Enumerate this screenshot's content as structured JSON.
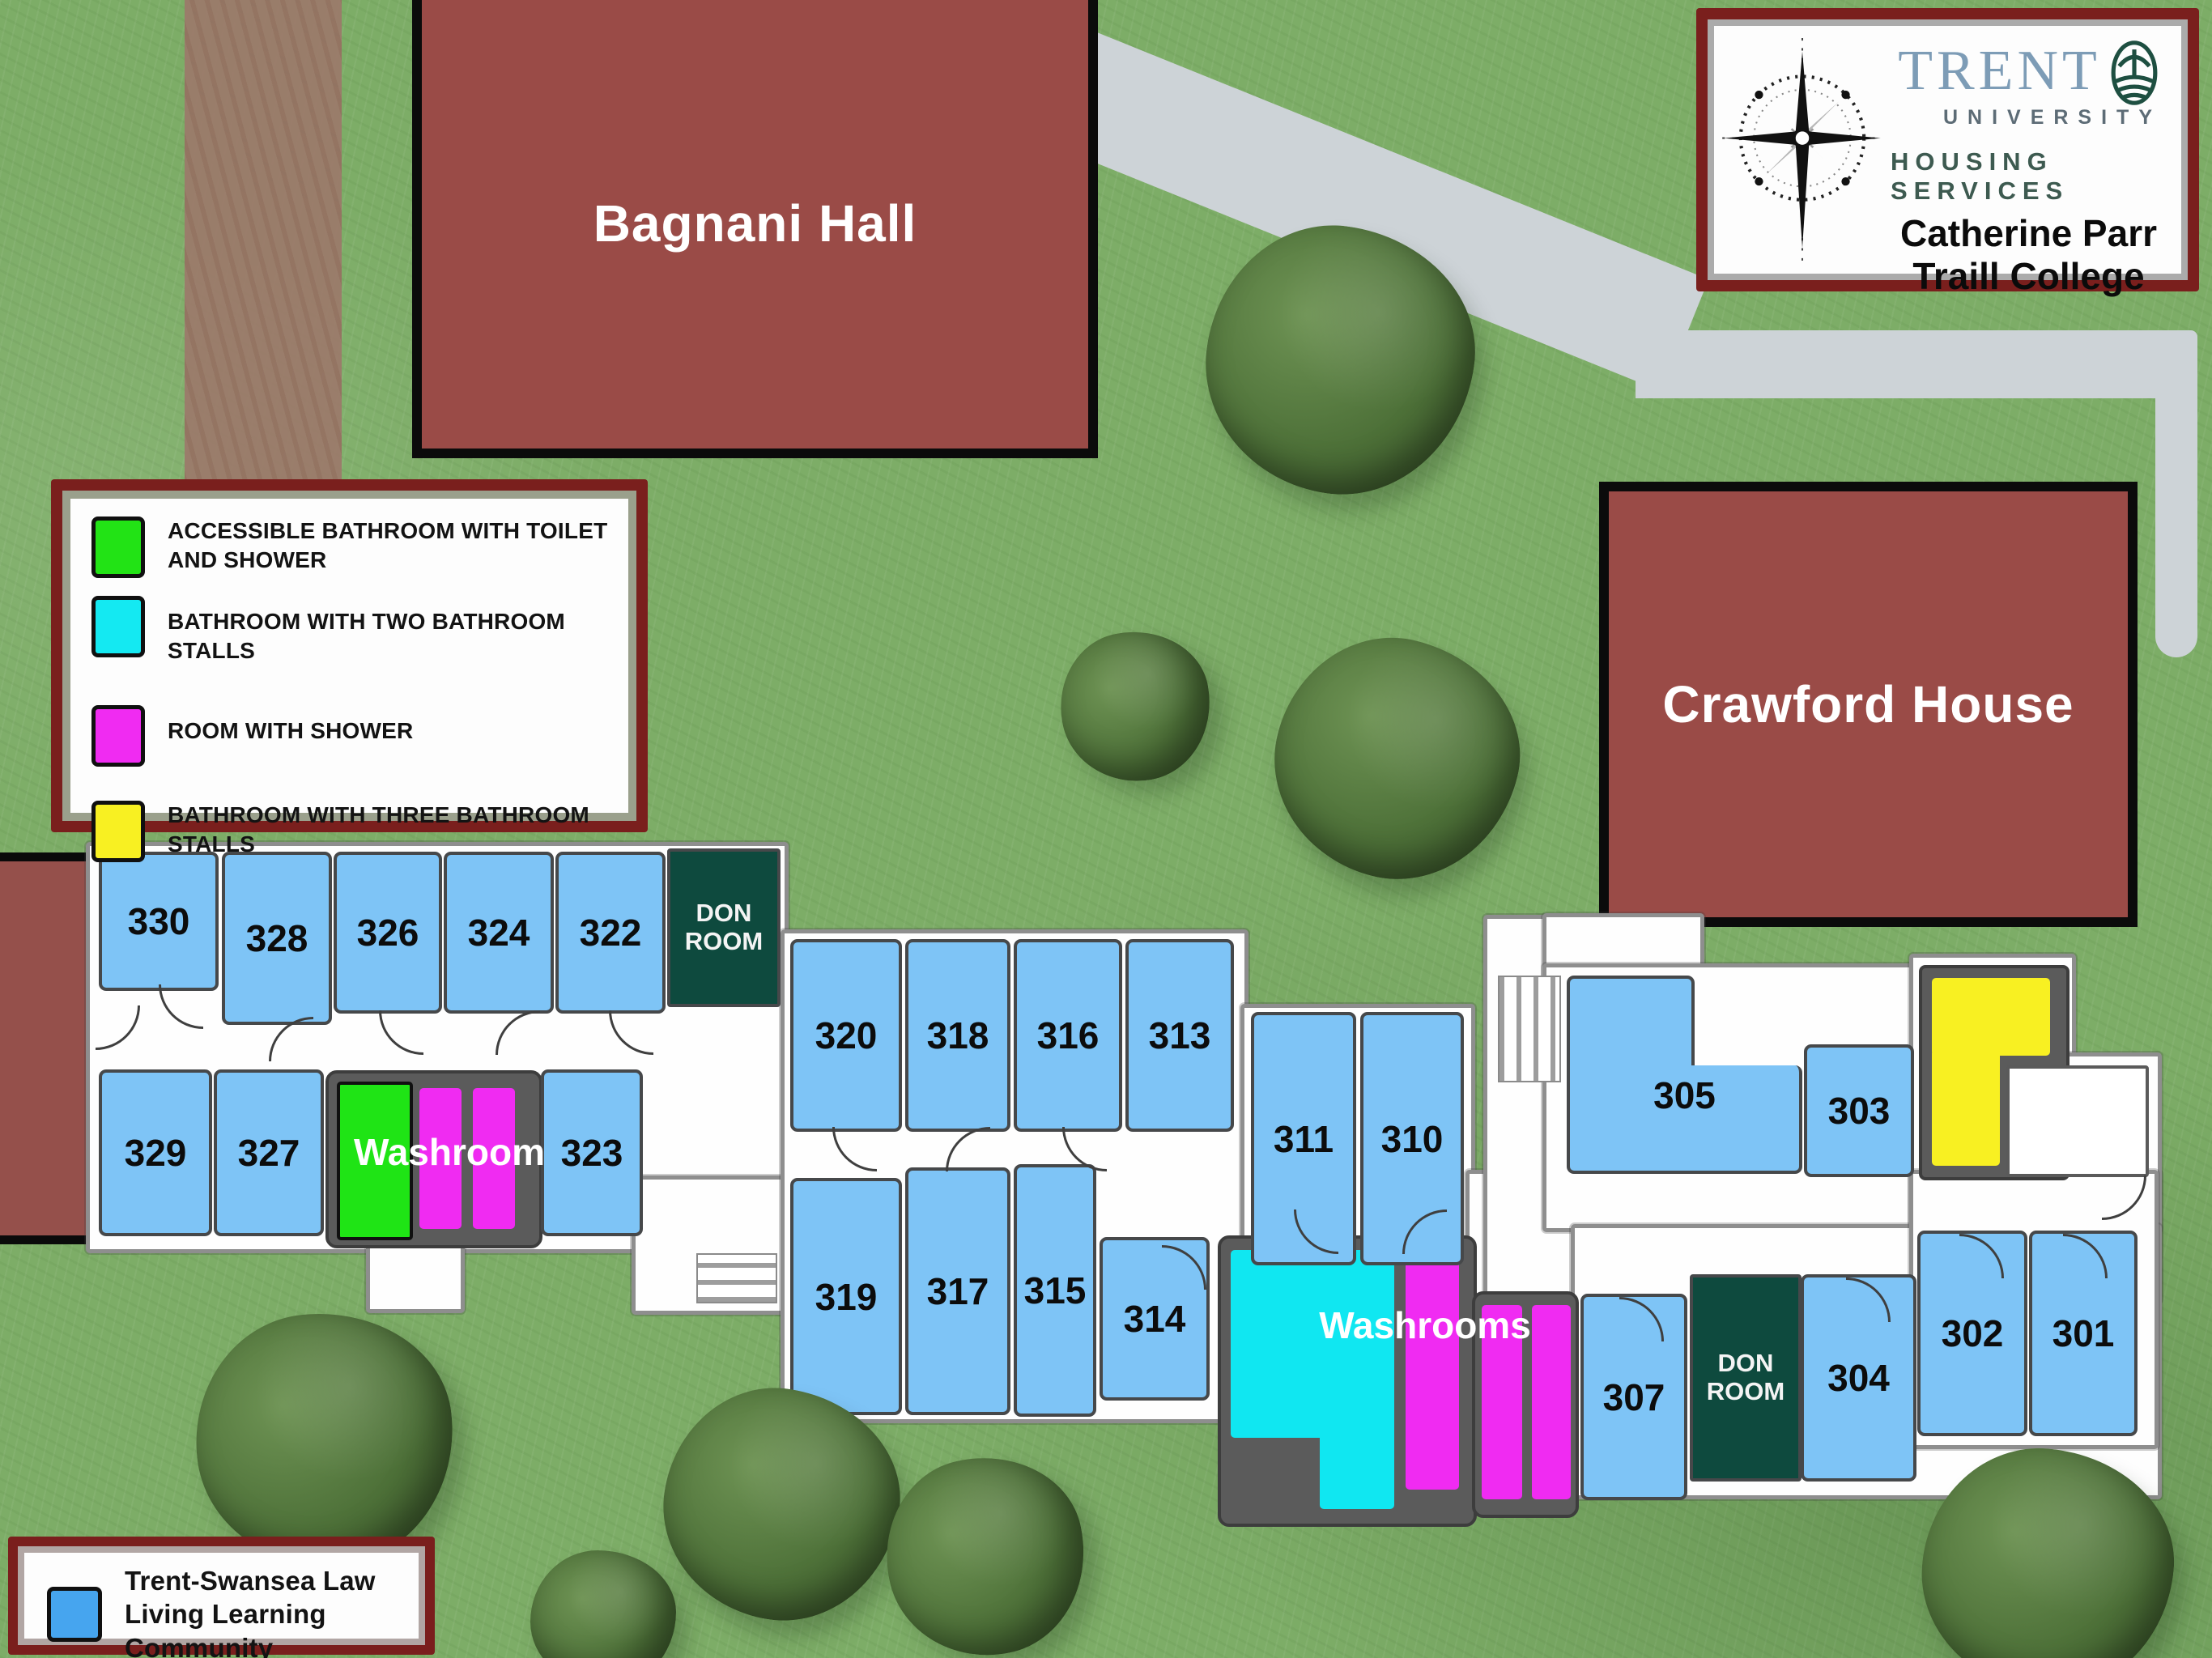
{
  "logo_box": {
    "trent": "TRENT",
    "university": "UNIVERSITY",
    "housing_services": "HOUSING SERVICES",
    "college_line1": "Catherine Parr",
    "college_line2": "Traill College"
  },
  "buildings": {
    "bagnani": "Bagnani Hall",
    "crawford": "Crawford House"
  },
  "legend": {
    "items": [
      {
        "label": "ACCESSIBLE BATHROOM WITH TOILET AND SHOWER",
        "color": "#22e315"
      },
      {
        "label": "BATHROOM WITH TWO BATHROOM STALLS",
        "color": "#14e9f2"
      },
      {
        "label": "ROOM WITH SHOWER",
        "color": "#f02bf2"
      },
      {
        "label": "BATHROOM WITH THREE BATHROOM STALLS",
        "color": "#f8f022"
      }
    ]
  },
  "community_legend": {
    "label": "Trent-Swansea Law Living Learning Community",
    "color": "#46a5ef"
  },
  "floorplan": {
    "don_room_label": "DON ROOM",
    "washroom_west_label": "Washroom",
    "washroom_east_label": "Washrooms",
    "room_fill_color": "#7ec4f6",
    "don_fill_color": "#0e4a3e",
    "rooms": {
      "r330": "330",
      "r328": "328",
      "r326": "326",
      "r324": "324",
      "r322": "322",
      "r329": "329",
      "r327": "327",
      "r323": "323",
      "r320": "320",
      "r318": "318",
      "r316": "316",
      "r313": "313",
      "r311": "311",
      "r310": "310",
      "r319": "319",
      "r317": "317",
      "r315": "315",
      "r314": "314",
      "r307": "307",
      "r305": "305",
      "r304": "304",
      "r303": "303",
      "r302": "302",
      "r301": "301"
    }
  }
}
